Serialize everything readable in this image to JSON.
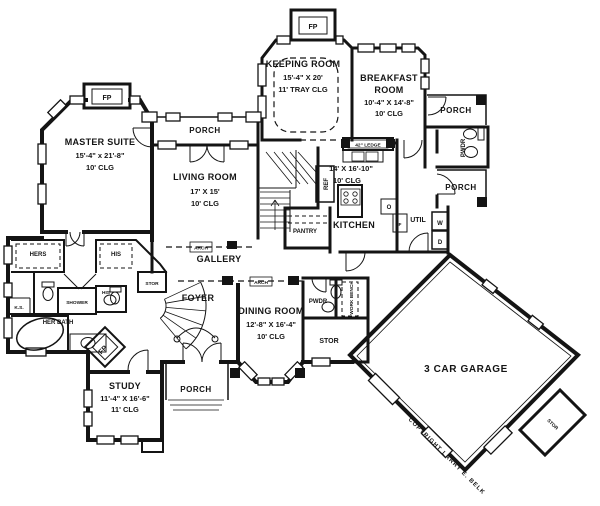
{
  "rooms": {
    "keeping": {
      "name": "KEEPING ROOM",
      "dims": "15'-4\" X 20'",
      "ceiling": "11' TRAY CLG"
    },
    "breakfast": {
      "name_line1": "BREAKFAST",
      "name_line2": "ROOM",
      "dims": "10'-4\" X 14'-8\"",
      "ceiling": "10' CLG"
    },
    "master": {
      "name": "MASTER SUITE",
      "dims": "15'-4\" x 21'-8\"",
      "ceiling": "10' CLG"
    },
    "living": {
      "name": "LIVING ROOM",
      "dims": "17' X 15'",
      "ceiling": "10' CLG"
    },
    "kitchen": {
      "name": "KITCHEN",
      "dims": "14' X 16'-10\"",
      "ceiling": "10' CLG"
    },
    "dining": {
      "name": "DINING ROOM",
      "dims": "12'-8\" X 16'-4\"",
      "ceiling": "10' CLG"
    },
    "study": {
      "name": "STUDY",
      "dims": "11'-4\" X 16'-6\"",
      "ceiling": "11' CLG"
    },
    "garage": {
      "name": "3 CAR GARAGE"
    },
    "foyer": {
      "name": "FOYER"
    },
    "gallery": {
      "name": "GALLERY"
    },
    "pantry": {
      "name": "PANTRY"
    },
    "util": {
      "name": "UTIL"
    },
    "pwdr": {
      "name": "PWDR"
    },
    "stor": {
      "name": "STOR"
    },
    "work_bench": {
      "name": "WORK BENCH"
    },
    "hers": {
      "name": "HERS"
    },
    "his": {
      "name": "HIS"
    },
    "shower": {
      "name": "SHOWER"
    },
    "her_bath": {
      "name": "HER BATH"
    },
    "knee_space": {
      "name": "K.S."
    },
    "porch": {
      "name": "PORCH"
    }
  },
  "annotations": {
    "fireplace": "FP",
    "ledge": "42\" LEDGE",
    "refrigerator": "REF",
    "washer": "W",
    "dryer": "D",
    "furnace": "F",
    "oven": "O",
    "arch": "ARCH",
    "copyright": "COPYRIGHT LARRY E. BELK"
  }
}
